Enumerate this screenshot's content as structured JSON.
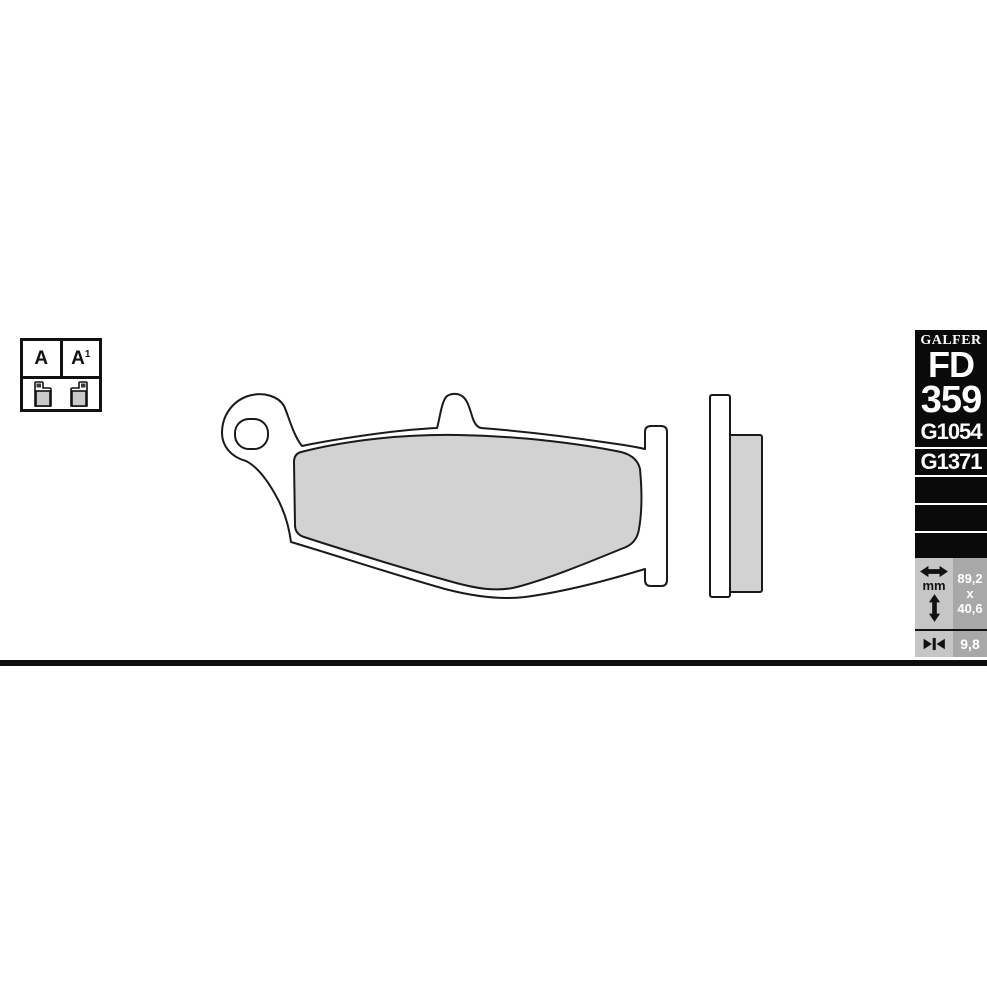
{
  "legend": {
    "cell_a": "A",
    "cell_a1_base": "A",
    "cell_a1_sup": "1"
  },
  "sidebar": {
    "brand": "GALFER",
    "model_prefix": "FD",
    "model_number": "359",
    "compound_codes": [
      "G1054",
      "G1371"
    ],
    "dimensions": {
      "unit": "mm",
      "width": "89,2",
      "separator": "x",
      "height": "40,6",
      "thickness": "9,8"
    },
    "colors": {
      "panel_bg": "#0a0a0a",
      "panel_text": "#ffffff",
      "cell_light": "#c6c6c6",
      "cell_dark": "#a8a8a8"
    }
  },
  "drawing": {
    "friction_fill": "#d2d2d2",
    "line_color": "#1a1a1a",
    "plate_fill": "#ffffff"
  }
}
